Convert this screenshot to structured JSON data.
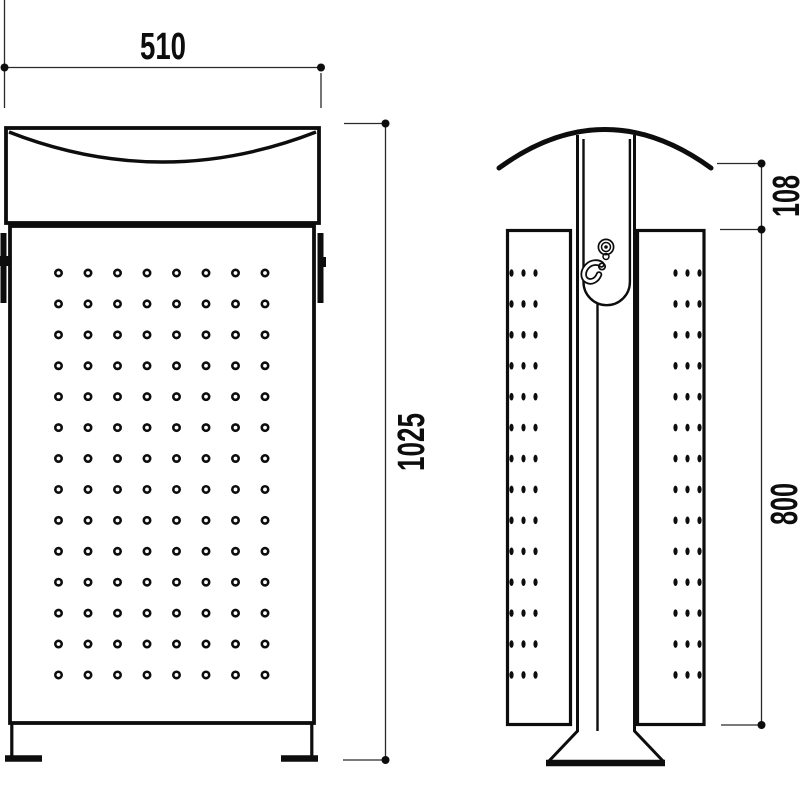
{
  "title": "Litter bin technical drawing - front and side elevation",
  "colors": {
    "background": "#ffffff",
    "ink": "#0d0d0d",
    "dimension_line": "#2a2a2a"
  },
  "dimensions": {
    "width_mm": {
      "label": "510"
    },
    "total_height_mm": {
      "label": "1025"
    },
    "lid_height_mm": {
      "label": "108"
    },
    "body_height_mm": {
      "label": "800"
    }
  },
  "front_view": {
    "name": "front-elevation",
    "hole_grid": {
      "rows": 14,
      "cols": 8,
      "x0": 58.5,
      "y0": 273,
      "dx": 29.5,
      "dy": 30.92,
      "r": 3.2,
      "stroke_w": 2.6
    }
  },
  "side_view": {
    "name": "side-elevation",
    "icons": [
      {
        "name": "lock-icon"
      },
      {
        "name": "hook-icon"
      }
    ],
    "left_hole_grid": {
      "rows": 14,
      "cols": 3,
      "x0": 511.5,
      "y0": 273,
      "dx": 12,
      "dy": 30.92,
      "rx": 2.1,
      "ry": 3.8
    },
    "right_hole_grid": {
      "rows": 14,
      "cols": 3,
      "x0": 675.5,
      "y0": 273,
      "dx": 12,
      "dy": 30.92,
      "rx": 2.1,
      "ry": 3.8
    }
  }
}
